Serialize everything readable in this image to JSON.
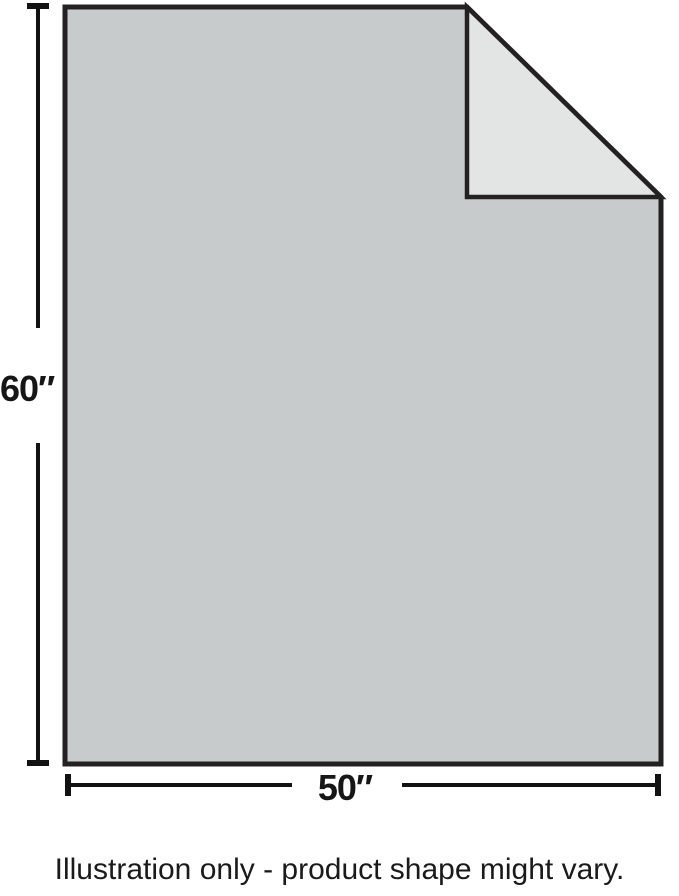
{
  "illustration": {
    "height_label": "60″",
    "width_label": "50″",
    "caption": "Illustration only - product shape might vary.",
    "colors": {
      "background": "#ffffff",
      "body_fill": "#c8cbcb",
      "flap_fill": "#e3e5e5",
      "outline": "#242122",
      "dimension_line": "#121212",
      "text": "#1a1a1a"
    }
  }
}
